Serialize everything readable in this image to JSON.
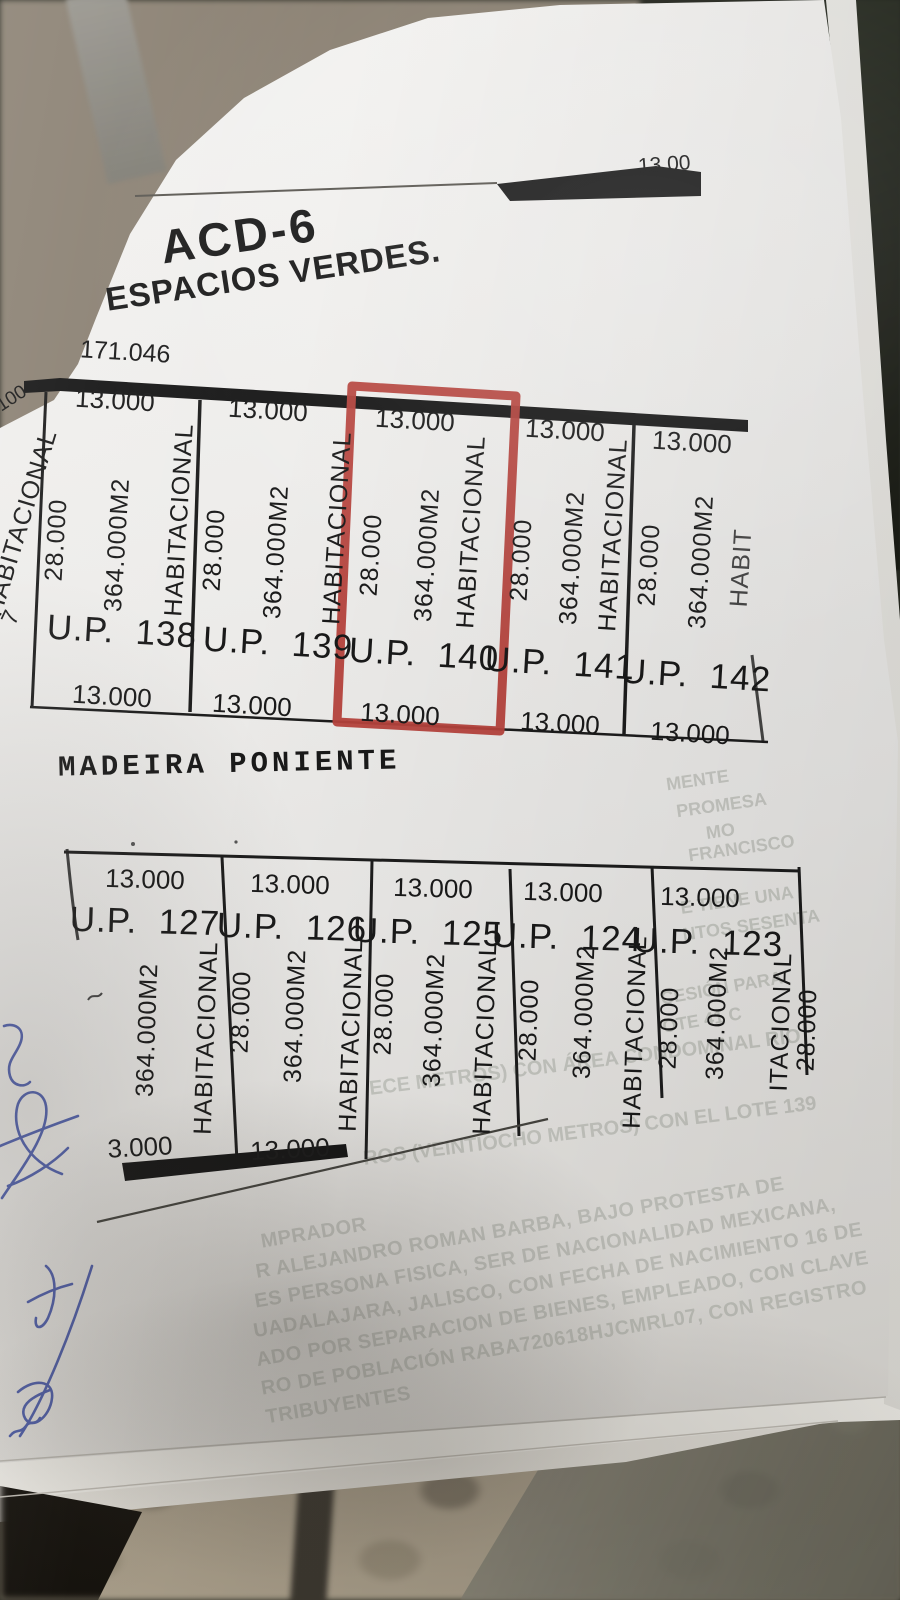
{
  "street_top_dim": "13.00",
  "title": "ACD-6",
  "subtitle": "ESPACIOS VERDES.",
  "street_label": "MADEIRA PONIENTE",
  "top_block": {
    "frontage_total": "171.046",
    "edge_remnants": {
      "dim_fragment": "100",
      "zoning": "HABITACIONAL",
      "lot_fragment": "7"
    },
    "lots": [
      {
        "id": "U.P.  138",
        "front": "13.000",
        "depth": "28.000",
        "area": "364.000M2",
        "zoning": "HABITACIONAL",
        "back": "13.000",
        "highlighted": false
      },
      {
        "id": "U.P.  139",
        "front": "13.000",
        "depth": "28.000",
        "area": "364.000M2",
        "zoning": "HABITACIONAL",
        "back": "13.000",
        "highlighted": false
      },
      {
        "id": "U.P.  140",
        "front": "13.000",
        "depth": "28.000",
        "area": "364.000M2",
        "zoning": "HABITACIONAL",
        "back": "13.000",
        "highlighted": true
      },
      {
        "id": "U.P.  141",
        "front": "13.000",
        "depth": "28.000",
        "area": "364.000M2",
        "zoning": "HABITACIONAL",
        "back": "13.000",
        "highlighted": false
      },
      {
        "id": "U.P.  142",
        "front": "13.000",
        "depth": "28.000",
        "area": "364.000M2",
        "zoning": "HABIT",
        "back": "13.000",
        "highlighted": false
      }
    ]
  },
  "bottom_block": {
    "lots": [
      {
        "id": "U.P.  127",
        "front": "13.000",
        "area": "364.000M2",
        "zoning": "HABITACIONAL",
        "back": "3.000"
      },
      {
        "id": "U.P.  126",
        "front": "13.000",
        "depth": "28.000",
        "area": "364.000M2",
        "zoning": "HABITACIONAL",
        "back": "13.000"
      },
      {
        "id": "U.P.  125",
        "front": "13.000",
        "depth": "28.000",
        "area": "364.000M2",
        "zoning": "HABITACIONAL"
      },
      {
        "id": "U.P.  124",
        "front": "13.000",
        "depth": "28.000",
        "area": "364.000M2",
        "zoning": "HABITACIONAL"
      },
      {
        "id": "U.P.  123",
        "front": "13.000",
        "depth": "28.000",
        "area": "364.000M2",
        "zoning": "ITACIONAL"
      }
    ],
    "right_edge_dim": "28.000"
  },
  "ghost_text": {
    "right_column": [
      "MENTE",
      "PROMESA",
      "MO",
      "FRANCISCO",
      "E TIENE UNA",
      "NTOS SESENTA",
      "CESIÓN PARA",
      "OTE 41 C"
    ],
    "mid_lines": [
      "ECE METROS) CON ÁREA CONDOMINAL RIO",
      "ROS (VEINTIOCHO METROS) CON EL LOTE 139"
    ],
    "paragraph": [
      "MPRADOR",
      "R ALEJANDRO ROMAN BARBA, BAJO PROTESTA DE",
      "ES PERSONA FISICA, SER DE NACIONALIDAD MEXICANA,",
      "UADALAJARA, JALISCO, CON FECHA DE NACIMIENTO 16 DE",
      "ADO POR SEPARACION DE BIENES, EMPLEADO, CON CLAVE",
      "RO DE POBLACIÓN RABA720618HJCMRL07, CON REGISTRO",
      "TRIBUYENTES"
    ]
  },
  "colors": {
    "highlight_red": "#b5423c",
    "ink": "#1a1a1a",
    "pen_blue": "#3c4da2",
    "ghost": "#a8aba3"
  }
}
